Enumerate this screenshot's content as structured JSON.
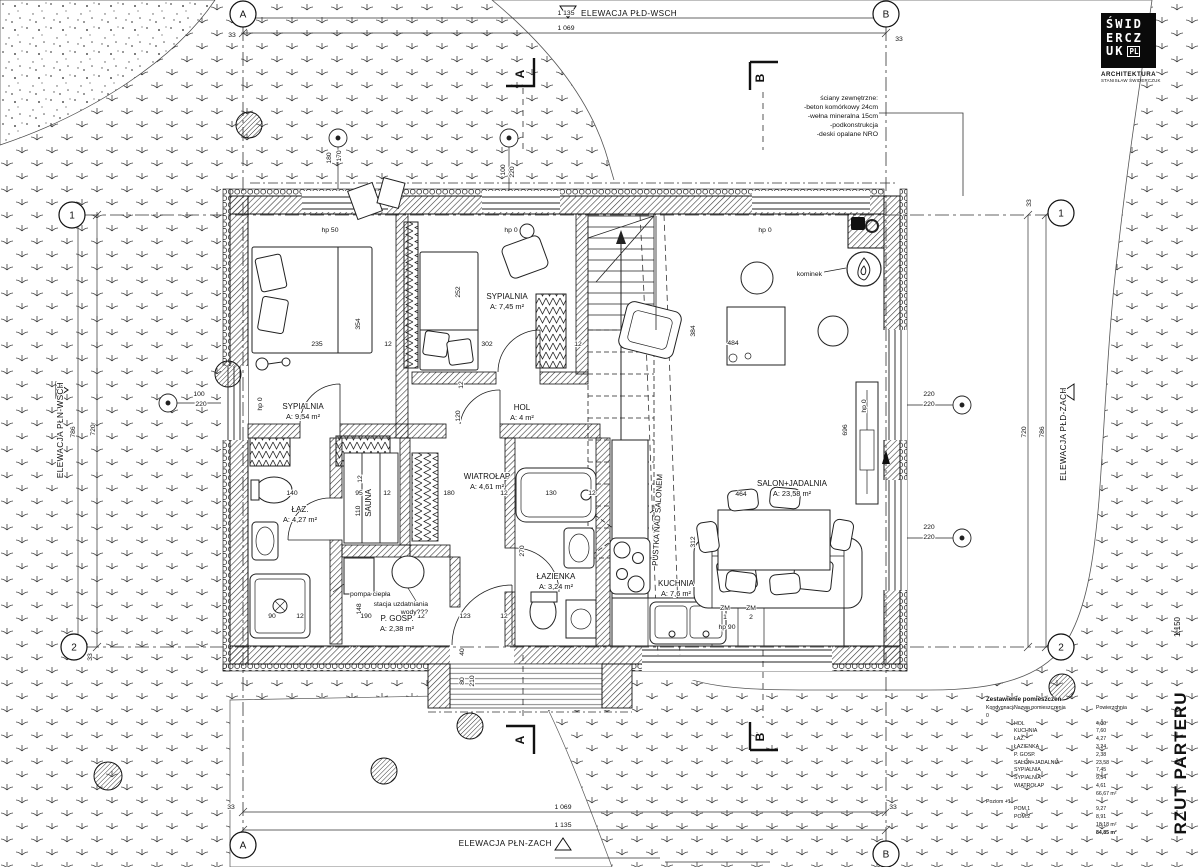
{
  "titles": {
    "drawing": "RZUT PARTERU",
    "scale": "1:150"
  },
  "logo": {
    "rows": [
      "ŚWID",
      "ERCZ",
      "UK"
    ],
    "suffix": "PL",
    "studio": "ARCHITEKTURA",
    "studio_sub": "STANISŁAW ŚWIDERCZUK"
  },
  "wall_note": {
    "lines": [
      "ściany zewnętrzne:",
      "-beton komórkowy 24cm",
      "-wełna mineralna 15cm",
      "-podkonstrukcja",
      "-deski opalane NRO"
    ]
  },
  "plan": {
    "rooms": [
      {
        "name": "SYPIALNIA",
        "area": "A: 9,54 m²",
        "x": 303,
        "y": 409
      },
      {
        "name": "SYPIALNIA",
        "area": "A: 7,45 m²",
        "x": 507,
        "y": 299
      },
      {
        "name": "HOL",
        "area": "A: 4 m²",
        "x": 522,
        "y": 410
      },
      {
        "name": "WIATROŁAP",
        "area": "A: 4,61 m²",
        "x": 487,
        "y": 479
      },
      {
        "name": "ŁAZ.",
        "area": "A: 4,27 m²",
        "x": 300,
        "y": 512
      },
      {
        "name": "SAUNA",
        "x": 371,
        "y": 503,
        "rot": -90
      },
      {
        "name": "ŁAZIENKA",
        "area": "A: 3,24 m²",
        "x": 556,
        "y": 579
      },
      {
        "name": "P. GOSP.",
        "area": "A: 2,38 m²",
        "x": 397,
        "y": 621
      },
      {
        "name": "KUCHNIA",
        "area": "A: 7,6 m²",
        "x": 676,
        "y": 586
      },
      {
        "name": "SALON+JADALNIA",
        "area": "A: 23,58 m²",
        "x": 792,
        "y": 486
      },
      {
        "name": "PUSTKA NAD SALONEM",
        "x": 660,
        "y": 520,
        "rot": -87
      }
    ],
    "annotations": [
      {
        "t": "kominek",
        "x": 822,
        "y": 276,
        "a": "end"
      },
      {
        "t": "pompa ciepła",
        "x": 350,
        "y": 596,
        "a": "start"
      },
      {
        "t": "stacja uzdatniania",
        "x": 428,
        "y": 606,
        "a": "end"
      },
      {
        "t": "wody???",
        "x": 428,
        "y": 614,
        "a": "end"
      },
      {
        "t": "ZM",
        "x": 725,
        "y": 610
      },
      {
        "t": "1",
        "x": 725,
        "y": 619
      },
      {
        "t": "ZM",
        "x": 751,
        "y": 610
      },
      {
        "t": "2",
        "x": 751,
        "y": 619
      },
      {
        "t": "hp 90",
        "x": 727,
        "y": 629
      }
    ],
    "dimensions": [
      {
        "t": "1 135",
        "x": 566,
        "y": 15
      },
      {
        "t": "1 069",
        "x": 566,
        "y": 30
      },
      {
        "t": "33",
        "x": 232,
        "y": 37
      },
      {
        "t": "33",
        "x": 899,
        "y": 41
      },
      {
        "t": "1 069",
        "x": 563,
        "y": 809
      },
      {
        "t": "1 135",
        "x": 563,
        "y": 827
      },
      {
        "t": "33",
        "x": 231,
        "y": 809
      },
      {
        "t": "33",
        "x": 893,
        "y": 809
      },
      {
        "t": "786",
        "x": 75,
        "y": 432,
        "r": -90
      },
      {
        "t": "720",
        "x": 95,
        "y": 430,
        "r": -90
      },
      {
        "t": "720",
        "x": 1026,
        "y": 432,
        "r": -90
      },
      {
        "t": "786",
        "x": 1044,
        "y": 432,
        "r": -90
      },
      {
        "t": "33",
        "x": 1031,
        "y": 203,
        "r": -90
      },
      {
        "t": "33",
        "x": 92,
        "y": 657,
        "r": -90
      },
      {
        "t": "180",
        "x": 331,
        "y": 158,
        "r": -90
      },
      {
        "t": "170",
        "x": 341,
        "y": 156,
        "r": -90
      },
      {
        "t": "100",
        "x": 505,
        "y": 170,
        "r": -90
      },
      {
        "t": "220",
        "x": 514,
        "y": 172,
        "r": -90
      },
      {
        "t": "100",
        "x": 199,
        "y": 396
      },
      {
        "t": "220",
        "x": 201,
        "y": 406
      },
      {
        "t": "220",
        "x": 929,
        "y": 396
      },
      {
        "t": "220",
        "x": 929,
        "y": 406
      },
      {
        "t": "220",
        "x": 929,
        "y": 529
      },
      {
        "t": "220",
        "x": 929,
        "y": 539
      },
      {
        "t": "235",
        "x": 317,
        "y": 346
      },
      {
        "t": "12",
        "x": 388,
        "y": 346
      },
      {
        "t": "354",
        "x": 360,
        "y": 324,
        "r": -90
      },
      {
        "t": "252",
        "x": 460,
        "y": 292,
        "r": -90
      },
      {
        "t": "302",
        "x": 487,
        "y": 346
      },
      {
        "t": "12",
        "x": 463,
        "y": 385,
        "r": -90
      },
      {
        "t": "12",
        "x": 578,
        "y": 346
      },
      {
        "t": "120",
        "x": 460,
        "y": 416,
        "r": -90
      },
      {
        "t": "140",
        "x": 292,
        "y": 495
      },
      {
        "t": "95",
        "x": 359,
        "y": 495
      },
      {
        "t": "12",
        "x": 387,
        "y": 495
      },
      {
        "t": "110",
        "x": 360,
        "y": 511,
        "r": -90
      },
      {
        "t": "12",
        "x": 362,
        "y": 479,
        "r": -90
      },
      {
        "t": "180",
        "x": 449,
        "y": 495
      },
      {
        "t": "12",
        "x": 504,
        "y": 495
      },
      {
        "t": "130",
        "x": 551,
        "y": 495
      },
      {
        "t": "12",
        "x": 592,
        "y": 495
      },
      {
        "t": "148",
        "x": 361,
        "y": 609,
        "r": -90
      },
      {
        "t": "90",
        "x": 272,
        "y": 618
      },
      {
        "t": "12",
        "x": 300,
        "y": 618
      },
      {
        "t": "190",
        "x": 366,
        "y": 618
      },
      {
        "t": "12",
        "x": 421,
        "y": 618
      },
      {
        "t": "123",
        "x": 465,
        "y": 618
      },
      {
        "t": "12",
        "x": 504,
        "y": 618
      },
      {
        "t": "270",
        "x": 524,
        "y": 551,
        "r": -90
      },
      {
        "t": "312",
        "x": 695,
        "y": 542,
        "r": -90
      },
      {
        "t": "384",
        "x": 695,
        "y": 331,
        "r": -90
      },
      {
        "t": "484",
        "x": 733,
        "y": 345
      },
      {
        "t": "464",
        "x": 741,
        "y": 496
      },
      {
        "t": "696",
        "x": 847,
        "y": 430,
        "r": -90
      },
      {
        "t": "hp 50",
        "x": 330,
        "y": 232
      },
      {
        "t": "hp 0",
        "x": 511,
        "y": 232
      },
      {
        "t": "hp 0",
        "x": 765,
        "y": 232
      },
      {
        "t": "hp 0",
        "x": 866,
        "y": 406,
        "r": -90
      },
      {
        "t": "hp 0",
        "x": 262,
        "y": 404,
        "r": -90
      },
      {
        "t": "40",
        "x": 464,
        "y": 652,
        "r": -90
      },
      {
        "t": "80",
        "x": 464,
        "y": 681,
        "r": -90
      },
      {
        "t": "210",
        "x": 474,
        "y": 681,
        "r": -90
      }
    ],
    "grid_bubbles": [
      {
        "t": "A",
        "x": 243,
        "y": 14
      },
      {
        "t": "B",
        "x": 886,
        "y": 14
      },
      {
        "t": "A",
        "x": 243,
        "y": 845
      },
      {
        "t": "B",
        "x": 886,
        "y": 854
      },
      {
        "t": "1",
        "x": 72,
        "y": 215
      },
      {
        "t": "2",
        "x": 74,
        "y": 647
      },
      {
        "t": "1",
        "x": 1061,
        "y": 213
      },
      {
        "t": "2",
        "x": 1061,
        "y": 647
      }
    ],
    "section_markers": [
      {
        "t": "A",
        "x": 524,
        "y": 74
      },
      {
        "t": "A",
        "x": 524,
        "y": 740
      },
      {
        "t": "B",
        "x": 764,
        "y": 78
      },
      {
        "t": "B",
        "x": 764,
        "y": 737
      }
    ],
    "elevation_labels": [
      {
        "t": "ELEWACJA PŁD-WSCH",
        "x": 581,
        "y": 16,
        "a": "start"
      },
      {
        "t": "ELEWACJA PŁN-ZACH",
        "x": 552,
        "y": 846,
        "a": "end"
      },
      {
        "t": "ELEWACJA PŁN-WSCH",
        "x": 63,
        "y": 430,
        "r": -90
      },
      {
        "t": "ELEWACJA PŁD-ZACH",
        "x": 1066,
        "y": 434,
        "r": -90
      }
    ]
  },
  "legend": {
    "title": "Zestawienie pomieszczeń",
    "headers": [
      "Kondygnacja",
      "Nazwa pomieszczenia",
      "Powierzchnia"
    ],
    "groups": [
      {
        "level": "0",
        "rows": [
          [
            "HOL",
            "4,00"
          ],
          [
            "KUCHNIA",
            "7,60"
          ],
          [
            "ŁAZ.",
            "4,27"
          ],
          [
            "ŁAZIENKA",
            "3,24"
          ],
          [
            "P. GOSP.",
            "2,38"
          ],
          [
            "SALON+JADALNIA",
            "23,58"
          ],
          [
            "SYPIALNIA",
            "7,45"
          ],
          [
            "SYPIALNIA",
            "9,54"
          ],
          [
            "WIATROŁAP",
            "4,61"
          ]
        ],
        "subtotal": "66,67 m²"
      },
      {
        "level": "Poziom +1",
        "rows": [
          [
            "POM.1",
            "9,27"
          ],
          [
            "POM.2",
            "8,91"
          ]
        ],
        "subtotal": "18,18 m²"
      }
    ],
    "total": "84,85 m²"
  }
}
